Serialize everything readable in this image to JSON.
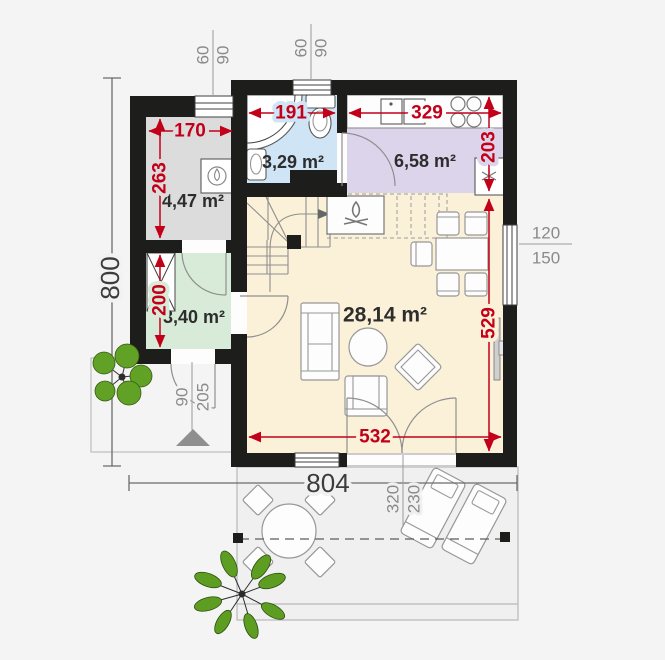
{
  "plan": {
    "type": "house ground floor plan with terrace",
    "colors": {
      "background": "#f4f4f4",
      "wall": "#1d1d1b",
      "dimension_red": "#c2001a",
      "dimension_gray": "#8a8a8a",
      "dimension_black": "#3c3c3c",
      "room_technical": "#dcdcdc",
      "room_bathroom": "#cfe4f4",
      "room_kitchen": "#dbd4ea",
      "room_hall": "#d8ebd8",
      "room_living": "#fbf1d8",
      "terrace": "#f0f0f0",
      "tree": "#5f9e28"
    }
  },
  "rooms": {
    "technical": {
      "area": "4,47 m²"
    },
    "bathroom": {
      "area": "3,29 m²"
    },
    "kitchen": {
      "area": "6,58 m²"
    },
    "hall": {
      "area": "3,40 m²"
    },
    "living": {
      "area": "28,14 m²"
    }
  },
  "dimensions": {
    "overall": {
      "height": "800",
      "width": "804"
    },
    "technical": {
      "width": "170",
      "height": "263"
    },
    "hall": {
      "height": "200"
    },
    "bathroom": {
      "width": "191"
    },
    "kitchen": {
      "width": "329",
      "height": "203"
    },
    "living": {
      "width": "532",
      "height": "529"
    },
    "window_top_left": {
      "width": "60",
      "height": "90"
    },
    "window_top_bath": {
      "width": "60",
      "height": "90"
    },
    "entry_door": {
      "width": "90",
      "height": "205"
    },
    "terrace_door": {
      "width": "320",
      "height": "230"
    },
    "side_window": {
      "width": "120",
      "height": "150"
    }
  }
}
